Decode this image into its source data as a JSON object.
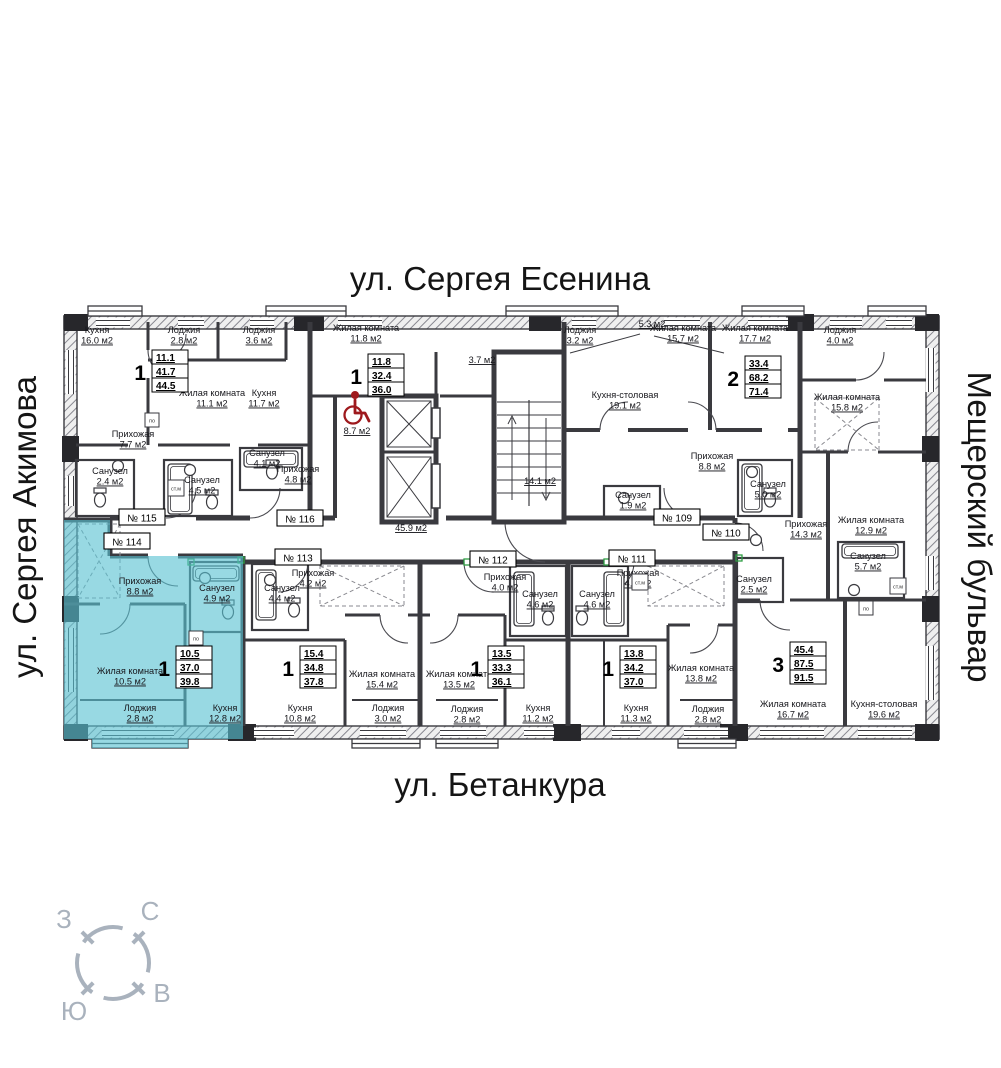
{
  "streets": {
    "top": "ул. Сергея Есенина",
    "bottom": "ул. Бетанкура",
    "left": "ул. Сергея Акимова",
    "right": "Мещерский бульвар"
  },
  "compass": {
    "north": "С",
    "south": "Ю",
    "west": "З",
    "east": "В"
  },
  "plan": {
    "colors": {
      "highlight": "#58c2d2",
      "wall": "#3a3a3f",
      "red_accent": "#9e191d",
      "compass": "#a9b2bd"
    },
    "apartments": [
      {
        "badge": "№ 115",
        "type": "1",
        "values": [
          "11.1",
          "41.7",
          "44.5"
        ],
        "badge_x": 142,
        "badge_y": 518,
        "box_x": 152,
        "box_y": 350,
        "highlighted": false
      },
      {
        "badge": "№ 116",
        "type": "1",
        "values": [
          "11.8",
          "32.4",
          "36.0"
        ],
        "badge_x": 300,
        "badge_y": 519,
        "box_x": 368,
        "box_y": 354,
        "highlighted": false
      },
      {
        "badge": "№ 109",
        "type": "2",
        "values": [
          "33.4",
          "68.2",
          "71.4"
        ],
        "badge_x": 677,
        "badge_y": 518,
        "box_x": 745,
        "box_y": 356,
        "highlighted": false
      },
      {
        "badge": "№ 110",
        "type": "3",
        "values": [
          "45.4",
          "87.5",
          "91.5"
        ],
        "badge_x": 726,
        "badge_y": 533,
        "box_x": 790,
        "box_y": 642,
        "highlighted": false
      },
      {
        "badge": "№ 111",
        "type": "1",
        "values": [
          "13.8",
          "34.2",
          "37.0"
        ],
        "badge_x": 632,
        "badge_y": 559,
        "box_x": 620,
        "box_y": 646,
        "highlighted": false
      },
      {
        "badge": "№ 112",
        "type": "1",
        "values": [
          "13.5",
          "33.3",
          "36.1"
        ],
        "badge_x": 493,
        "badge_y": 560,
        "box_x": 488,
        "box_y": 646,
        "highlighted": false
      },
      {
        "badge": "№ 113",
        "type": "1",
        "values": [
          "15.4",
          "34.8",
          "37.8"
        ],
        "badge_x": 298,
        "badge_y": 558,
        "box_x": 300,
        "box_y": 646,
        "highlighted": false
      },
      {
        "badge": "№ 114",
        "type": "1",
        "values": [
          "10.5",
          "37.0",
          "39.8"
        ],
        "badge_x": 127,
        "badge_y": 542,
        "box_x": 176,
        "box_y": 646,
        "highlighted": true
      }
    ],
    "rooms": [
      {
        "label": "Кухня",
        "area": "16.0 м2",
        "x": 97,
        "y": 333
      },
      {
        "label": "Лоджия",
        "area": "2.8 м2",
        "x": 184,
        "y": 333
      },
      {
        "label": "Лоджия",
        "area": "3.6 м2",
        "x": 259,
        "y": 333
      },
      {
        "label": "Жилая комната",
        "area": "11.8 м2",
        "x": 366,
        "y": 331
      },
      {
        "label": "Жилая комната",
        "area": "11.1 м2",
        "x": 212,
        "y": 396
      },
      {
        "label": "Кухня",
        "area": "11.7 м2",
        "x": 264,
        "y": 396
      },
      {
        "label": "Прихожая",
        "area": "7.7 м2",
        "x": 133,
        "y": 437
      },
      {
        "label": "Санузел",
        "area": "2.4 м2",
        "x": 110,
        "y": 474
      },
      {
        "label": "Санузел",
        "area": "4.5 м2",
        "x": 202,
        "y": 483
      },
      {
        "label": "Санузел",
        "area": "4.1 м2",
        "x": 267,
        "y": 456
      },
      {
        "label": "Прихожая",
        "area": "4.8 м2",
        "x": 298,
        "y": 472
      },
      {
        "label": "",
        "area": "8.7 м2",
        "x": 357,
        "y": 434
      },
      {
        "label": "",
        "area": "45.9 м2",
        "x": 411,
        "y": 531
      },
      {
        "label": "",
        "area": "14.1 м2",
        "x": 540,
        "y": 484
      },
      {
        "label": "",
        "area": "5.3 м2",
        "x": 652,
        "y": 327
      },
      {
        "label": "",
        "area": "3.7 м2",
        "x": 482,
        "y": 363
      },
      {
        "label": "Лоджия",
        "area": "3.2 м2",
        "x": 580,
        "y": 333
      },
      {
        "label": "Кухня-столовая",
        "area": "19.1 м2",
        "x": 625,
        "y": 398
      },
      {
        "label": "Санузел",
        "area": "1.9 м2",
        "x": 633,
        "y": 498
      },
      {
        "label": "Жилая комната",
        "area": "15.7 м2",
        "x": 683,
        "y": 331
      },
      {
        "label": "Жилая комната",
        "area": "17.7 м2",
        "x": 755,
        "y": 331
      },
      {
        "label": "Лоджия",
        "area": "4.0 м2",
        "x": 840,
        "y": 333
      },
      {
        "label": "Жилая комната",
        "area": "15.8 м2",
        "x": 847,
        "y": 400
      },
      {
        "label": "Прихожая",
        "area": "8.8 м2",
        "x": 712,
        "y": 459
      },
      {
        "label": "Санузел",
        "area": "5.0 м2",
        "x": 768,
        "y": 487
      },
      {
        "label": "Прихожая",
        "area": "14.3 м2",
        "x": 806,
        "y": 527
      },
      {
        "label": "Жилая комната",
        "area": "12.9 м2",
        "x": 871,
        "y": 523
      },
      {
        "label": "Санузел",
        "area": "5.7 м2",
        "x": 868,
        "y": 559
      },
      {
        "label": "Санузел",
        "area": "2.5 м2",
        "x": 754,
        "y": 582
      },
      {
        "label": "Прихожая",
        "area": "8.8 м2",
        "x": 140,
        "y": 584
      },
      {
        "label": "Санузел",
        "area": "4.9 м2",
        "x": 217,
        "y": 591
      },
      {
        "label": "Жилая комната",
        "area": "10.5 м2",
        "x": 130,
        "y": 674
      },
      {
        "label": "Лоджия",
        "area": "2.8 м2",
        "x": 140,
        "y": 711
      },
      {
        "label": "Кухня",
        "area": "12.8 м2",
        "x": 225,
        "y": 711
      },
      {
        "label": "Прихожая",
        "area": "4.2 м2",
        "x": 313,
        "y": 576
      },
      {
        "label": "Санузел",
        "area": "4.4 м2",
        "x": 282,
        "y": 591
      },
      {
        "label": "Кухня",
        "area": "10.8 м2",
        "x": 300,
        "y": 711
      },
      {
        "label": "Жилая комната",
        "area": "15.4 м2",
        "x": 382,
        "y": 677
      },
      {
        "label": "Лоджия",
        "area": "3.0 м2",
        "x": 388,
        "y": 711
      },
      {
        "label": "Жилая комната",
        "area": "13.5 м2",
        "x": 459,
        "y": 677
      },
      {
        "label": "Лоджия",
        "area": "2.8 м2",
        "x": 467,
        "y": 712
      },
      {
        "label": "Прихожая",
        "area": "4.0 м2",
        "x": 505,
        "y": 580
      },
      {
        "label": "Санузел",
        "area": "4.6 м2",
        "x": 540,
        "y": 597
      },
      {
        "label": "Санузел",
        "area": "4.6 м2",
        "x": 597,
        "y": 597
      },
      {
        "label": "Кухня",
        "area": "11.2 м2",
        "x": 538,
        "y": 711
      },
      {
        "label": "Прихожая",
        "area": "4.5 м2",
        "x": 638,
        "y": 576
      },
      {
        "label": "Кухня",
        "area": "11.3 м2",
        "x": 636,
        "y": 711
      },
      {
        "label": "Жилая комната",
        "area": "13.8 м2",
        "x": 701,
        "y": 671
      },
      {
        "label": "Лоджия",
        "area": "2.8 м2",
        "x": 708,
        "y": 712
      },
      {
        "label": "Жилая комната",
        "area": "16.7 м2",
        "x": 793,
        "y": 707
      },
      {
        "label": "Кухня-столовая",
        "area": "19.6 м2",
        "x": 884,
        "y": 707
      }
    ],
    "appliances": {
      "washer_label": "ст.м",
      "stove_label": "по",
      "washers": [
        [
          176,
          488
        ],
        [
          640,
          582
        ],
        [
          898,
          586
        ]
      ],
      "stoves": [
        [
          152,
          420
        ],
        [
          196,
          638
        ],
        [
          866,
          608
        ]
      ]
    }
  }
}
